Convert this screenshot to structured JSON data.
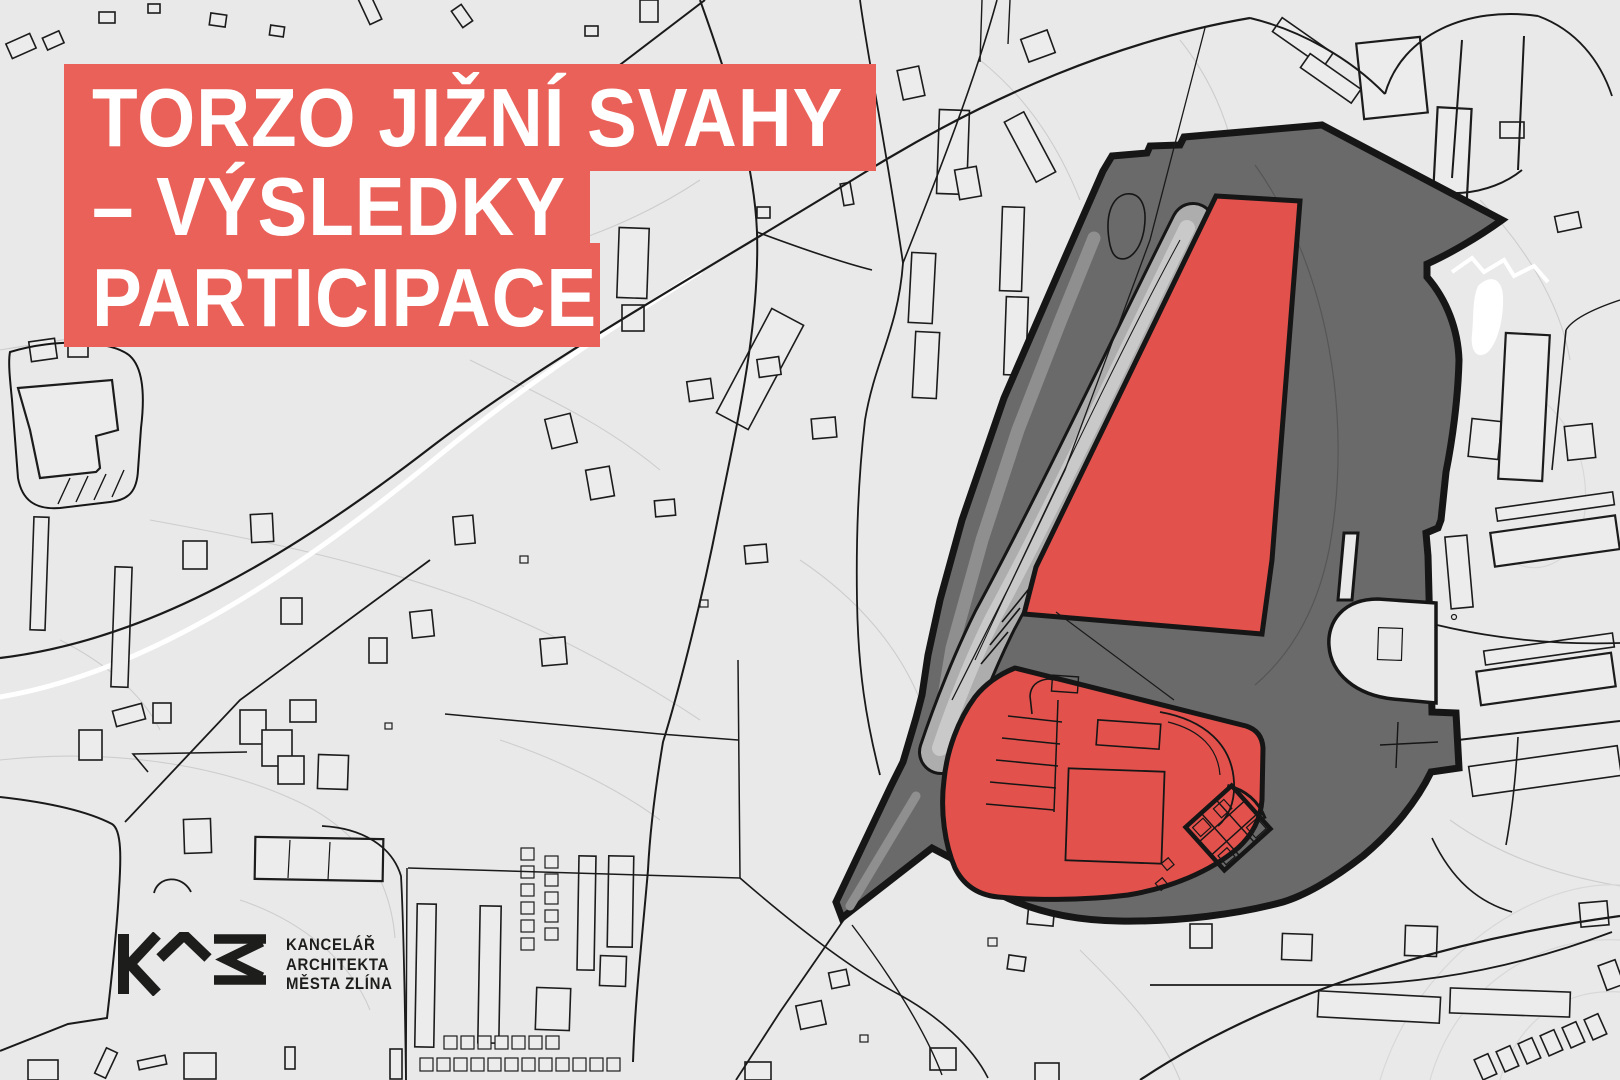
{
  "poster": {
    "title": {
      "line1": "TORZO JIŽNÍ SVAHY",
      "line2": "– VÝSLEDKY",
      "line3": "PARTICIPACE"
    },
    "logo": {
      "line1": "KANCELÁŘ",
      "line2": "ARCHITEKTA",
      "line3": "MĚSTA ZLÍNA"
    }
  },
  "colors": {
    "map_bg": "#E9E9E9",
    "banner_red": "#EA6159",
    "area_red": "#E2514C",
    "area_dark": "#6A6A6A",
    "outline": "#161616",
    "building_fill": "#ECECEC",
    "building_stroke": "#1C1C1C",
    "parcel_line": "#CDCDCD",
    "contour_line": "#D8D8D8",
    "road_black": "#1A1A1A",
    "road_white": "#FFFFFF",
    "strip_gray": "#ADADAD",
    "strip_inner": "#C9C9C9",
    "inner_band": "#8F8F8F",
    "pond_white": "#FFFFFF",
    "title_text": "#FFFFFF",
    "logo_ink": "#1D1D1B"
  }
}
